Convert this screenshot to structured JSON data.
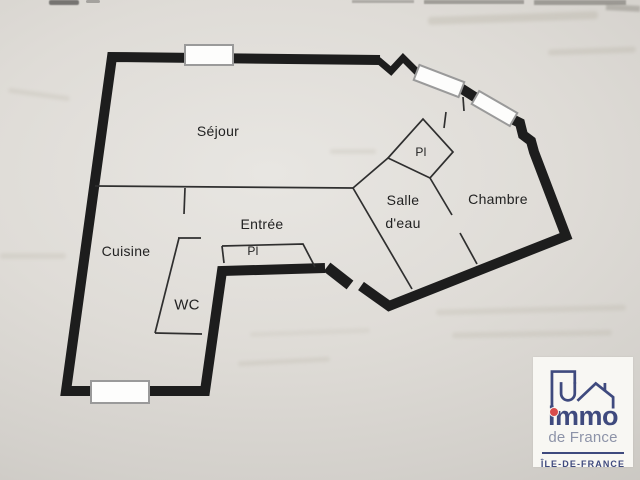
{
  "floorplan": {
    "rooms": {
      "sejour": "Séjour",
      "cuisine": "Cuisine",
      "entree": "Entrée",
      "wc": "WC",
      "salle_eau_l1": "Salle",
      "salle_eau_l2": "d'eau",
      "chambre": "Chambre",
      "placard_entree": "Pl",
      "placard_chambre": "Pl"
    },
    "colors": {
      "wall": "#1d1d1d",
      "interior_wall": "#2f2f2f",
      "window_frame": "#9a9a9a",
      "window_fill": "#fdfdfc"
    }
  },
  "logo": {
    "brand": "immo",
    "brand_sub": "de France",
    "region": "ÎLE-DE-FRANCE",
    "colors": {
      "navy": "#3f4a7e",
      "red": "#d84b4b",
      "slate": "#8d93a8"
    }
  }
}
